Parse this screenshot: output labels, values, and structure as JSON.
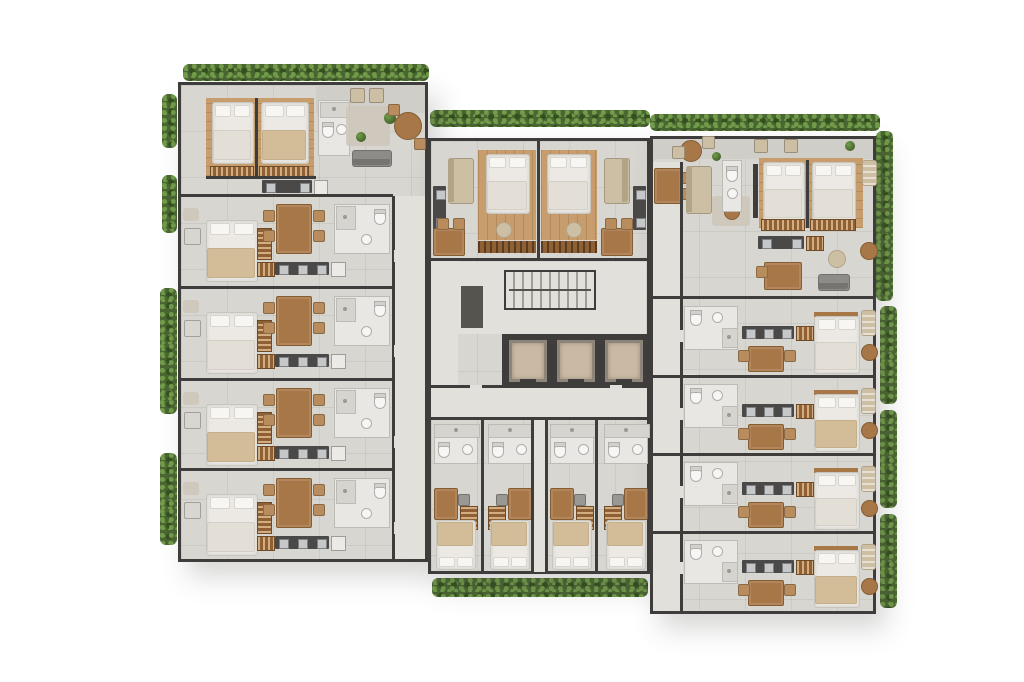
{
  "summary": {
    "type": "residential-floor-plan-render",
    "wings": 3,
    "elevators": 3,
    "stairwells": 1,
    "units_depicted": {
      "two_bedroom_apartments": 2,
      "one_bedroom_units": 2,
      "studios": 8,
      "micro_studios": 4
    }
  },
  "palette": {
    "bg": "#ffffff",
    "floor": "#d8d6d1",
    "floor2": "#e2e0db",
    "terrace": "#d0cec8",
    "wall": "#3e3d3b",
    "wall_mid": "#6b6966",
    "wood": "#c79d6e",
    "wood_dark": "#b68a59",
    "furn_wood": "#a87748",
    "furn_wood_dark": "#855d32",
    "closet_wood": "#8f6034",
    "counter": "#4b4947",
    "steel": "#c6c7c9",
    "steel_line": "#7e7f82",
    "bed": "#ece9e4",
    "pillow": "#f7f6f3",
    "blanket_tan": "#d3bd98",
    "blanket_white": "#e3dfd7",
    "tan": "#cdbfa4",
    "tan_dark": "#b3a488",
    "sofa_gray": "#8e8c89",
    "sofa_gray_dark": "#767470",
    "tile": "#e8e7e4",
    "tile_line": "#bdbbb6",
    "fixture": "#f7f6f4",
    "fixture_line": "#b0aeaa",
    "shower": "#d6d4cf",
    "hedge": "#4a6632",
    "hedge_light": "#729c4a",
    "hedge_dark": "#33501f",
    "cabin": "#cbbaa3",
    "cabin_frame": "#8d8579",
    "rug": "#cdc7ba",
    "util": "#56544f"
  },
  "scene": {
    "slabs": [
      {
        "name": "left-wing-slab",
        "x": 178,
        "y": 82,
        "w": 250,
        "h": 480
      },
      {
        "name": "center-slab",
        "x": 428,
        "y": 138,
        "w": 222,
        "h": 436
      },
      {
        "name": "right-wing-slab",
        "x": 650,
        "y": 136,
        "w": 226,
        "h": 478
      }
    ],
    "patios": [
      {
        "name": "left-wing-roof-terrace",
        "x": 316,
        "y": 85,
        "w": 109,
        "h": 28
      },
      {
        "name": "right-wing-roof-terrace",
        "x": 653,
        "y": 139,
        "w": 220,
        "h": 20
      }
    ],
    "hedges": [
      {
        "name": "hedge-top-left",
        "x": 183,
        "y": 64,
        "w": 246,
        "h": 17
      },
      {
        "name": "hedge-left-a",
        "x": 162,
        "y": 94,
        "w": 15,
        "h": 54
      },
      {
        "name": "hedge-left-b",
        "x": 162,
        "y": 175,
        "w": 15,
        "h": 58
      },
      {
        "name": "hedge-left-c",
        "x": 160,
        "y": 288,
        "w": 17,
        "h": 126
      },
      {
        "name": "hedge-left-d",
        "x": 160,
        "y": 453,
        "w": 17,
        "h": 92
      },
      {
        "name": "hedge-top-center",
        "x": 430,
        "y": 110,
        "w": 220,
        "h": 17
      },
      {
        "name": "hedge-top-right",
        "x": 650,
        "y": 114,
        "w": 230,
        "h": 17
      },
      {
        "name": "hedge-right-a",
        "x": 876,
        "y": 131,
        "w": 17,
        "h": 170
      },
      {
        "name": "hedge-right-b",
        "x": 880,
        "y": 306,
        "w": 17,
        "h": 98
      },
      {
        "name": "hedge-right-c",
        "x": 880,
        "y": 410,
        "w": 17,
        "h": 98
      },
      {
        "name": "hedge-right-d",
        "x": 880,
        "y": 514,
        "w": 17,
        "h": 94
      },
      {
        "name": "hedge-bottom-center",
        "x": 432,
        "y": 578,
        "w": 216,
        "h": 19
      }
    ],
    "corridors": [
      {
        "name": "left-wing-corridor",
        "x": 394,
        "y": 196,
        "w": 31,
        "h": 363
      },
      {
        "name": "core-west-corridor",
        "x": 431,
        "y": 260,
        "w": 27,
        "h": 158
      },
      {
        "name": "main-corridor",
        "x": 431,
        "y": 388,
        "w": 216,
        "h": 30
      },
      {
        "name": "stair-hall",
        "x": 458,
        "y": 262,
        "w": 188,
        "h": 72
      },
      {
        "name": "micro-corridor",
        "x": 534,
        "y": 420,
        "w": 12,
        "h": 152
      },
      {
        "name": "right-wing-corridor",
        "x": 653,
        "y": 162,
        "w": 27,
        "h": 449
      }
    ],
    "walls": [
      {
        "name": "wall-apt-a-bedrooms",
        "x": 206,
        "y": 176,
        "w": 110,
        "h": 3
      },
      {
        "name": "wall-apt-a-divider",
        "x": 255,
        "y": 98,
        "w": 3,
        "h": 78
      },
      {
        "name": "wall-left-row-1",
        "x": 181,
        "y": 194,
        "w": 212,
        "h": 3
      },
      {
        "name": "wall-left-row-2",
        "x": 181,
        "y": 286,
        "w": 212,
        "h": 3
      },
      {
        "name": "wall-left-row-3",
        "x": 181,
        "y": 378,
        "w": 212,
        "h": 3
      },
      {
        "name": "wall-left-row-4",
        "x": 181,
        "y": 468,
        "w": 212,
        "h": 3
      },
      {
        "name": "wall-left-corridor",
        "x": 392,
        "y": 196,
        "w": 3,
        "h": 363
      },
      {
        "name": "wall-center-units",
        "x": 431,
        "y": 258,
        "w": 216,
        "h": 3
      },
      {
        "name": "wall-center-divider",
        "x": 537,
        "y": 140,
        "w": 3,
        "h": 118
      },
      {
        "name": "wall-main-corridor-n",
        "x": 431,
        "y": 385,
        "w": 216,
        "h": 3
      },
      {
        "name": "wall-main-corridor-s",
        "x": 431,
        "y": 417,
        "w": 216,
        "h": 3
      },
      {
        "name": "wall-micro-1",
        "x": 481,
        "y": 420,
        "w": 3,
        "h": 152
      },
      {
        "name": "wall-micro-2",
        "x": 531,
        "y": 420,
        "w": 3,
        "h": 152
      },
      {
        "name": "wall-micro-3",
        "x": 545,
        "y": 420,
        "w": 3,
        "h": 152
      },
      {
        "name": "wall-micro-4",
        "x": 595,
        "y": 420,
        "w": 3,
        "h": 152
      },
      {
        "name": "wall-right-row-1",
        "x": 653,
        "y": 296,
        "w": 222,
        "h": 3
      },
      {
        "name": "wall-right-row-2",
        "x": 653,
        "y": 375,
        "w": 222,
        "h": 3
      },
      {
        "name": "wall-right-row-3",
        "x": 653,
        "y": 453,
        "w": 222,
        "h": 3
      },
      {
        "name": "wall-right-row-4",
        "x": 653,
        "y": 531,
        "w": 222,
        "h": 3
      },
      {
        "name": "wall-right-corridor",
        "x": 680,
        "y": 162,
        "w": 3,
        "h": 449
      },
      {
        "name": "wall-apt-d-tv",
        "x": 753,
        "y": 164,
        "w": 5,
        "h": 54
      },
      {
        "name": "wall-apt-d-divider",
        "x": 806,
        "y": 160,
        "w": 3,
        "h": 68
      }
    ],
    "core": {
      "stairs": {
        "x": 504,
        "y": 270,
        "w": 92,
        "h": 40
      },
      "lockers": [
        {
          "x": 461,
          "y": 286,
          "w": 22,
          "h": 42
        }
      ],
      "shaft": {
        "x": 502,
        "y": 334,
        "w": 146,
        "h": 54
      },
      "cabins": [
        {
          "x": 509,
          "y": 340
        },
        {
          "x": 557,
          "y": 340
        },
        {
          "x": 605,
          "y": 340
        }
      ],
      "cabin_size": {
        "w": 38,
        "h": 42
      }
    },
    "units": [
      {
        "name": "apartment-a",
        "type": "apt-left",
        "x": 178,
        "y": 82
      },
      {
        "name": "studio-a1",
        "type": "studio-left",
        "x": 178,
        "y": 196,
        "blanket": "tan"
      },
      {
        "name": "studio-a2",
        "type": "studio-left",
        "x": 178,
        "y": 288,
        "blanket": "white"
      },
      {
        "name": "studio-a3",
        "type": "studio-left",
        "x": 178,
        "y": 380,
        "blanket": "tan"
      },
      {
        "name": "studio-a4",
        "type": "studio-left",
        "x": 178,
        "y": 470,
        "blanket": "white"
      },
      {
        "name": "unit-b1",
        "type": "one-bed",
        "x": 428,
        "y": 138,
        "flip": false
      },
      {
        "name": "unit-b2",
        "type": "one-bed",
        "x": 538,
        "y": 138,
        "flip": true
      },
      {
        "name": "micro-c1",
        "type": "micro",
        "x": 430,
        "flip": false
      },
      {
        "name": "micro-c2",
        "type": "micro",
        "x": 484,
        "flip": true
      },
      {
        "name": "micro-c3",
        "type": "micro",
        "x": 546,
        "flip": false
      },
      {
        "name": "micro-c4",
        "type": "micro",
        "x": 600,
        "flip": true
      },
      {
        "name": "apartment-d",
        "type": "apt-right",
        "x": 650,
        "y": 136
      },
      {
        "name": "studio-e1",
        "type": "studio-right",
        "x": 650,
        "y": 300,
        "blanket": "white"
      },
      {
        "name": "studio-e2",
        "type": "studio-right",
        "x": 650,
        "y": 378,
        "blanket": "tan"
      },
      {
        "name": "studio-e3",
        "type": "studio-right",
        "x": 650,
        "y": 456,
        "blanket": "white"
      },
      {
        "name": "studio-e4",
        "type": "studio-right",
        "x": 650,
        "y": 534,
        "blanket": "tan"
      }
    ]
  }
}
